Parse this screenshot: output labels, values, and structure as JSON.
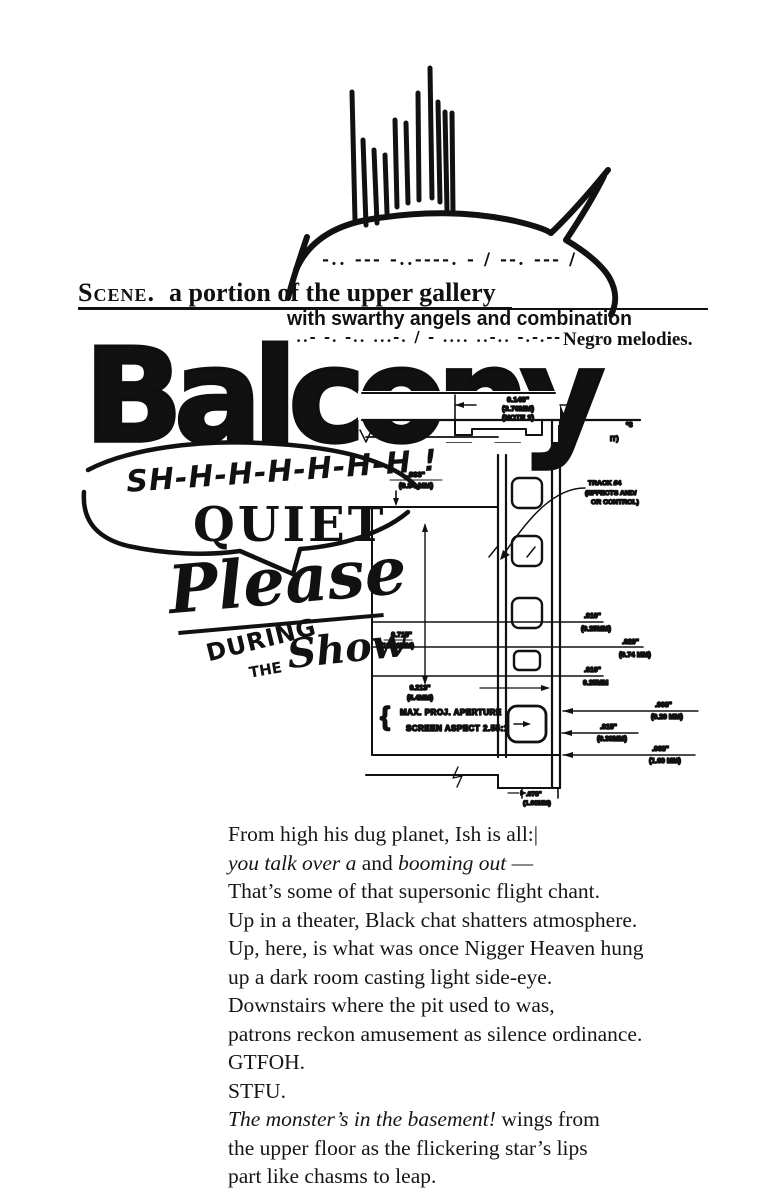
{
  "page": {
    "background": "#ffffff",
    "ink": "#111111"
  },
  "collage": {
    "morse_top": "-.. --- -..----. - / --. --- /",
    "scene_word": "Scene.",
    "scene_rest": "a portion of the upper gallery",
    "swarthy_line": "with swarthy angels and combination",
    "morse_mid": "..- -. -.. ...-. / - .... ..-.. -.-.--",
    "melodies": "Negro melodies.",
    "balcony": "Balcony",
    "shh": "SH-H-H-H-H-H-H !",
    "quiet": "QUIET",
    "please": "Please",
    "during": "DURING",
    "the": "THE",
    "show": "Show"
  },
  "diagram": {
    "top_width_in": "0.148\"",
    "top_width_mm": "(3.76MM)",
    "top_width_note": "(NOTE 2)",
    "frag_left": "(1.",
    "frag_right": "IT)",
    "frag_star": "*3",
    "edge_in": ".033\"",
    "edge_mm": "(0.84 MM)",
    "track_line1": "TRACK #4",
    "track_line2": "(EFFECTS AND/",
    "track_line3": "OR CONTROL)",
    "dim1_in": ".010\"",
    "dim1_mm": "(0.25MM)",
    "dim2_in": ".029\"",
    "dim2_mm": "(0.74 MM)",
    "dim3_in": ".010\"",
    "dim3_mm": "0.25MM",
    "height_in": "0.715\"",
    "height_mm": "(18.16MM)",
    "frame_in": "0.213\"",
    "frame_mm": "(5.4MM)",
    "brace": "{",
    "aperture_line1": "MAX. PROJ. APERTURE",
    "aperture_line2": "SCREEN ASPECT 2.55:1",
    "dim4_in": ".008\"",
    "dim4_mm": "(0.20 MM)",
    "dim5_in": ".015\"",
    "dim5_mm": "(0.38MM)",
    "dim6_in": ".063\"",
    "dim6_mm": "(1.60 MM)",
    "bottom_in": ".078\"",
    "bottom_mm": "(1.98MM)"
  },
  "poem": {
    "lines": [
      {
        "segs": [
          {
            "t": "From high his dug planet, Ish is all:|"
          }
        ]
      },
      {
        "segs": [
          {
            "t": "you talk over a"
          },
          {
            "t": " and "
          },
          {
            "t": "booming out"
          },
          {
            "t": " —"
          }
        ]
      },
      {
        "segs": [
          {
            "t": "That’s some of that supersonic flight chant."
          }
        ]
      },
      {
        "segs": [
          {
            "t": "Up in a theater, Black chat shatters atmosphere."
          }
        ]
      },
      {
        "segs": [
          {
            "t": "Up, here, is what was once Nigger Heaven hung"
          }
        ]
      },
      {
        "segs": [
          {
            "t": "up a dark room casting light side-eye."
          }
        ]
      },
      {
        "segs": [
          {
            "t": "Downstairs where the pit used to was,"
          }
        ]
      },
      {
        "segs": [
          {
            "t": "patrons reckon amusement as silence ordinance."
          }
        ]
      },
      {
        "segs": [
          {
            "t": "GTFOH."
          }
        ]
      },
      {
        "segs": [
          {
            "t": "STFU."
          }
        ]
      },
      {
        "segs": [
          {
            "t": "The monster’s in the basement!"
          },
          {
            "t": " wings from"
          }
        ]
      },
      {
        "segs": [
          {
            "t": "the upper floor as the flickering star’s lips"
          }
        ]
      },
      {
        "segs": [
          {
            "t": "part like chasms to leap."
          }
        ]
      }
    ]
  }
}
